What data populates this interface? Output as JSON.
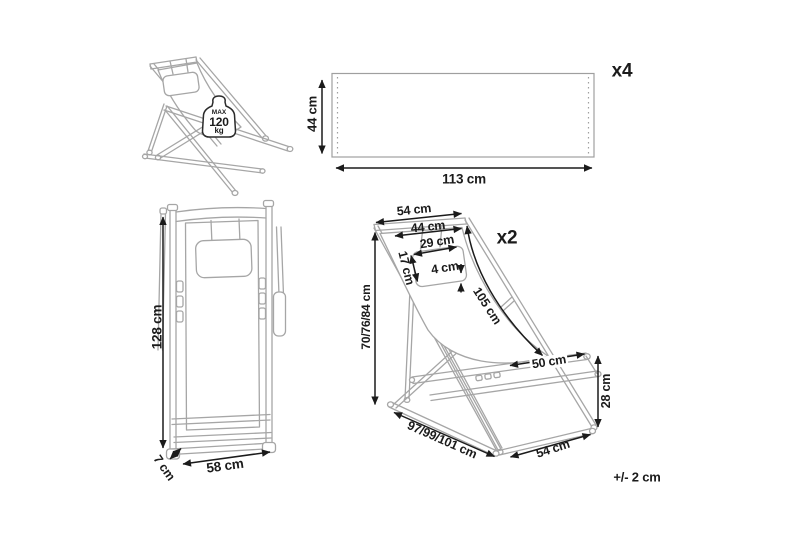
{
  "diagram": {
    "tolerance_note": "+/- 2 cm",
    "colors": {
      "line_art": "#a6a6a6",
      "dimension": "#1b1b1b"
    },
    "views": {
      "side": {
        "max_load_label": "MAX",
        "max_load_value": "120",
        "max_load_unit": "kg"
      },
      "fabric_panel": {
        "quantity": "x4",
        "height": "44 cm",
        "width": "113 cm"
      },
      "folded_front": {
        "height": "128 cm",
        "depth": "7 cm",
        "width": "58 cm"
      },
      "perspective": {
        "quantity": "x2",
        "top_width": "54 cm",
        "hanger_width": "44 cm",
        "pillow_width": "29 cm",
        "pillow_height": "17 cm",
        "pillow_thickness": "4 cm",
        "sling_length": "105 cm",
        "frame_heights": "70/76/84 cm",
        "seat_depth": "50 cm",
        "seat_front_height": "28 cm",
        "frame_lengths": "97/99/101 cm",
        "base_width": "54 cm"
      }
    }
  }
}
